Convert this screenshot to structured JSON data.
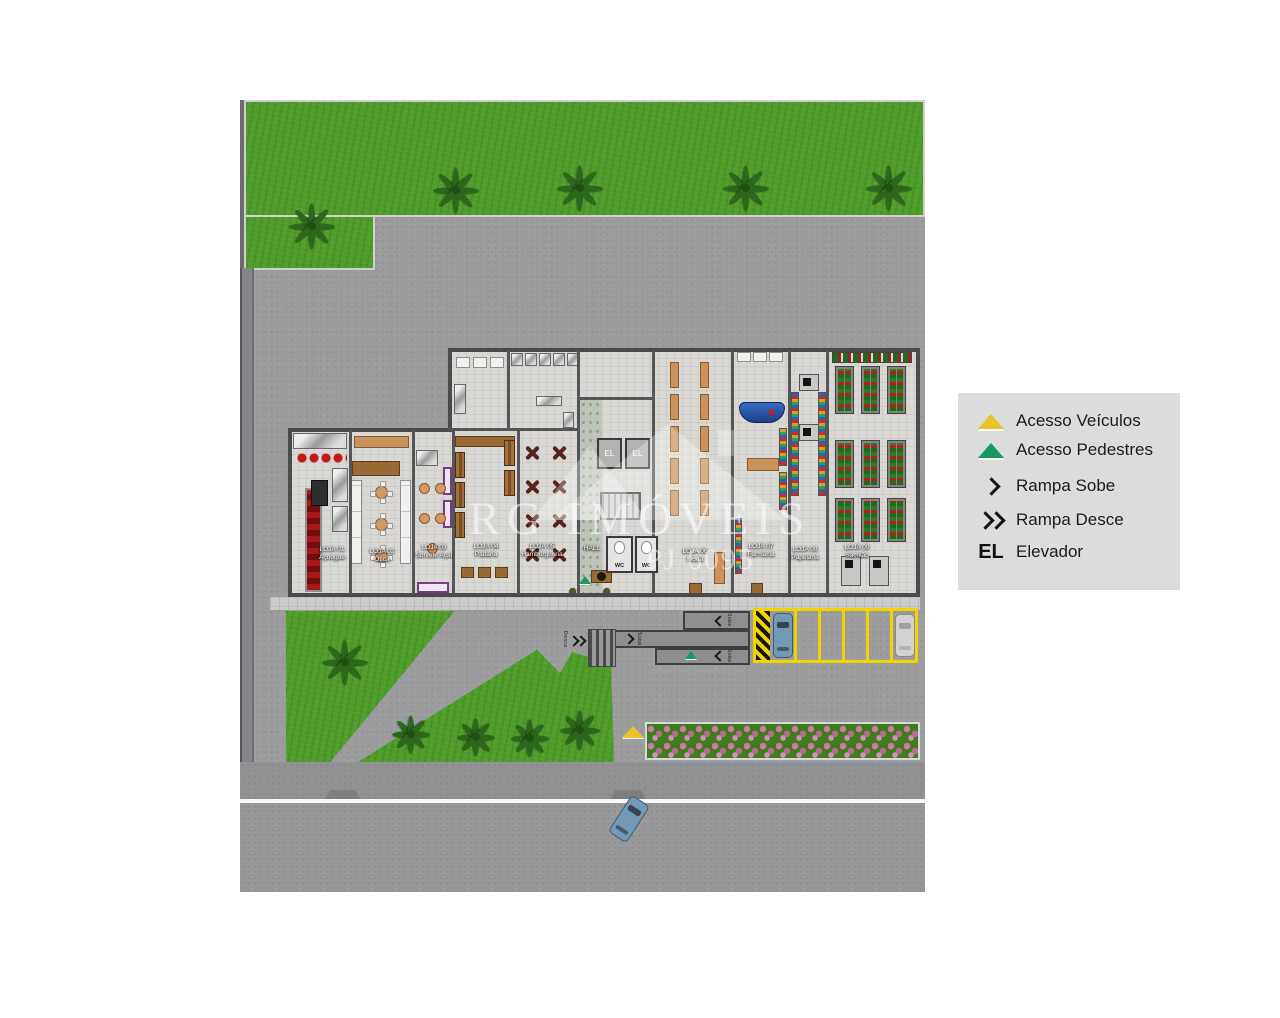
{
  "legend": {
    "items": [
      {
        "name": "acesso-veiculos",
        "label": "Acesso Veículos"
      },
      {
        "name": "acesso-pedestres",
        "label": "Acesso Pedestres"
      },
      {
        "name": "rampa-sobe",
        "label": "Rampa Sobe"
      },
      {
        "name": "rampa-desce",
        "label": "Rampa Desce"
      },
      {
        "name": "elevador",
        "label": "Elevador",
        "symbol": "EL"
      }
    ]
  },
  "watermark": {
    "brand": "RG IMÓVEIS",
    "license": "PJ 6095"
  },
  "floorplan": {
    "shops": [
      {
        "line1": "LOJA 01",
        "line2": "Açougue"
      },
      {
        "line1": "LOJA 02",
        "line2": "Ótica"
      },
      {
        "line1": "LOJA 03",
        "line2": "Sorvete Açaí"
      },
      {
        "line1": "LOJA 04",
        "line2": "Padaria"
      },
      {
        "line1": "LOJA 05",
        "line2": "Hamburgueria"
      },
      {
        "line1": "LOJA 06",
        "line2": "Moda"
      },
      {
        "line1": "LOJA 07",
        "line2": "Farmácia"
      },
      {
        "line1": "LOJA 08",
        "line2": "Papelaria"
      },
      {
        "line1": "LOJA 09",
        "line2": "Sacolão"
      }
    ],
    "hall_label": "HALL",
    "wc_label": "WC",
    "elevator_label": "EL",
    "ramp_up_label": "Sobe",
    "ramp_down_label": "Desce"
  },
  "colors": {
    "grass": "#4f9d2a",
    "asphalt": "#9c9c9e",
    "road": "#97979a",
    "floor": "#d9d8d5",
    "wall": "#4a4a4c",
    "legend_bg": "#dcdcdc",
    "access_vehicles_yellow": "#e8c32a",
    "access_pedestrians_green": "#159a63",
    "parking_yellow": "#f0d400",
    "hedge_pink": "#d391b3"
  }
}
